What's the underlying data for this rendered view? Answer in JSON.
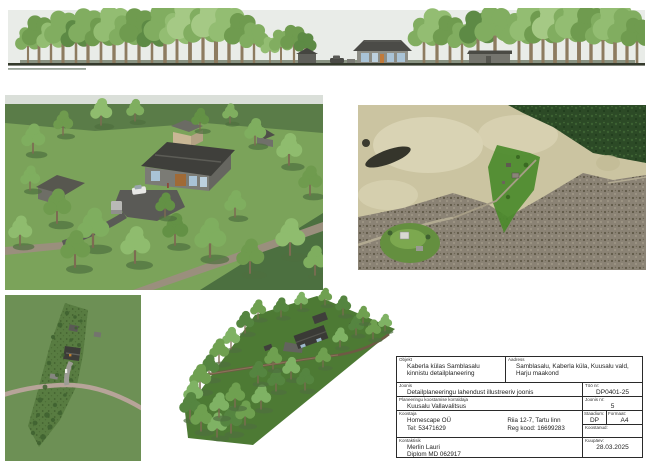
{
  "document": {
    "kind": "detail-plan illustration sheet",
    "sheet_background": "#ffffff"
  },
  "figures": {
    "panorama": {
      "name": "tree-line-elevation-view"
    },
    "perspective": {
      "name": "site-perspective-3d-render"
    },
    "aerial": {
      "name": "aerial-orthophoto-with-parcel-highlight"
    },
    "plan": {
      "name": "site-plan-top-view"
    },
    "iso": {
      "name": "site-isometric-3d-render"
    }
  },
  "title_block": {
    "objekt": {
      "label": "Objekt",
      "line1": "Kaberla külas Samblasalu",
      "line2": "kinnistu detailplaneering"
    },
    "aadress": {
      "label": "Aadress",
      "line1": "Samblasalu, Kaberla küla, Kuusalu vald,",
      "line2": "Harju maakond"
    },
    "joonis": {
      "label": "Joonis",
      "value": "Detailplaneeringu lahendust illustreeriv joonis"
    },
    "korraldaja": {
      "label": "Planeeringu koostamise korraldaja",
      "value": "Kuusalu Vallavalitsus"
    },
    "koostaja": {
      "label": "Koostaja",
      "col1_line1": "Homescape OÜ",
      "col2_line1": "Riia 12-7, Tartu linn",
      "col1_line2": "Tel: 53471629",
      "col2_line2": "Reg kood: 16699283"
    },
    "kontaktisik": {
      "label": "Kontaktisik",
      "line1": "Merlin Lauri",
      "line2": "Diplom MD 062917"
    },
    "too_nr": {
      "label": "Töö nr:",
      "value": "DP0401-25"
    },
    "joonis_nr": {
      "label": "Joonis nr:",
      "value": "5"
    },
    "staadium": {
      "label": "Staadium:",
      "value": "DP"
    },
    "formaat": {
      "label": "Formaat:",
      "value": "A4"
    },
    "koostanud": {
      "label": "Koostanud:",
      "value": ""
    },
    "kuupaev": {
      "label": "Kuupäev:",
      "value": "28.03.2025"
    }
  },
  "colors": {
    "sky": "#e9ece8",
    "lawn_green": "#7ba35a",
    "parcel_highlight_green": "#4b8a2b",
    "roof_dark": "#45453f",
    "window_blue": "#a9c3d6",
    "dirt_road": "#9a8f7d",
    "aerial_field_tan": "#cbc4a1",
    "bare_forest_gray": "#8b8375",
    "conifer_green": "#2c4a26",
    "plan_road_pink": "#b7a499"
  }
}
